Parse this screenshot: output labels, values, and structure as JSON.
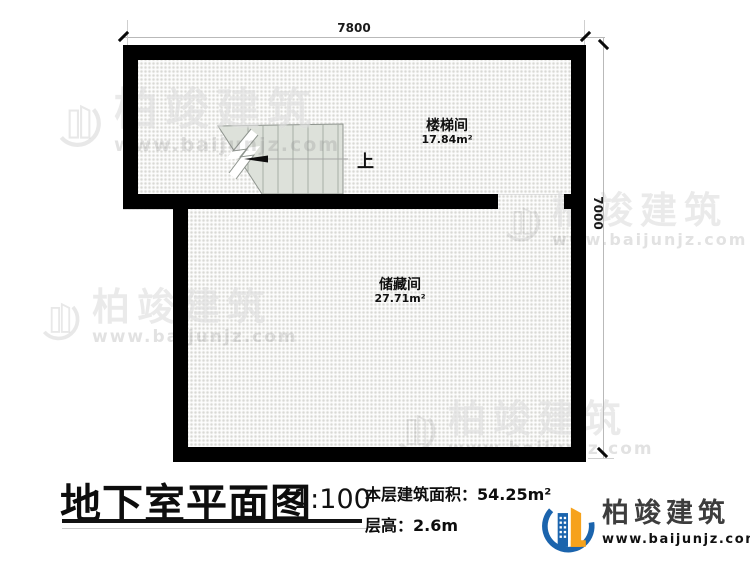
{
  "plan": {
    "dim_top": "7800",
    "dim_right": "7000",
    "rooms": [
      {
        "name": "楼梯间",
        "area": "17.84m²"
      },
      {
        "name": "储藏间",
        "area": "27.71m²"
      }
    ],
    "stair_up_label": "上"
  },
  "title_block": {
    "title": "地下室平面图",
    "scale": "1:100",
    "area_label": "本层建筑面积：",
    "area_value": "54.25m²",
    "height_label": "层高：",
    "height_value": "2.6m"
  },
  "brand": {
    "name": "柏竣建筑",
    "url": "www.baijunjz.com",
    "colors": {
      "blue": "#1b64ad",
      "orange": "#f6a21c",
      "wall": "#000000",
      "stair_fill": "#dde1da"
    }
  },
  "watermark": {
    "name": "柏竣建筑",
    "url": "www.baijunjz.com"
  }
}
